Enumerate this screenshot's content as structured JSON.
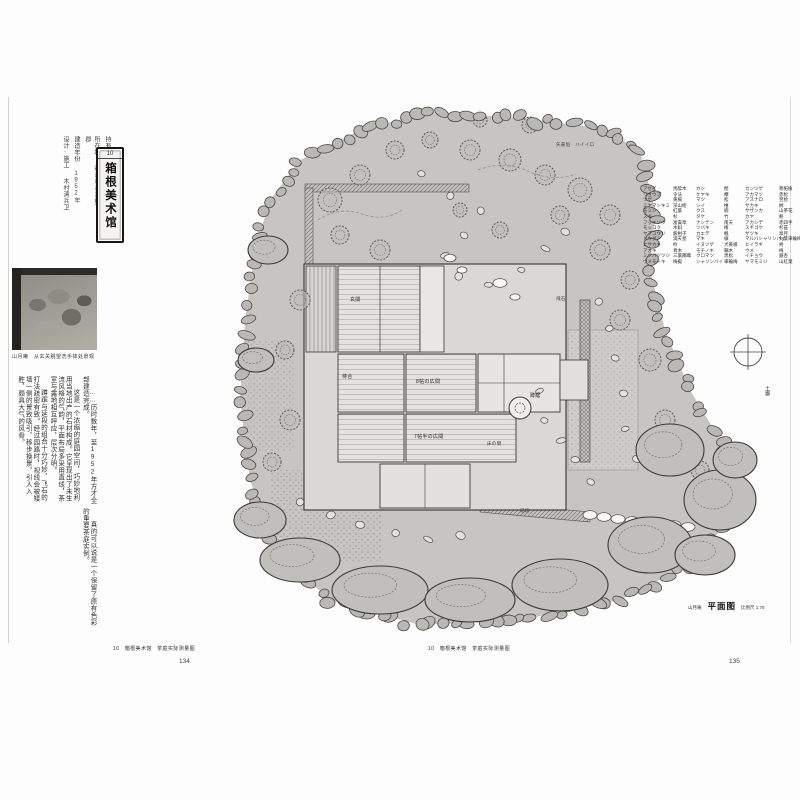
{
  "book": {
    "left_caption": "10　箱根美术馆　茶庭实际测量图",
    "right_caption": "10　箱根美术馆　茶庭实际测量图",
    "left_page_number": "134",
    "right_page_number": "135"
  },
  "left": {
    "chapter_no": "10",
    "title": "箱根美术馆",
    "meta": [
      {
        "label": "持有人",
        "value": "世界救世教"
      },
      {
        "label": "所在地",
        "value": "神奈川县足柄下郡"
      },
      {
        "label": "建造年份",
        "value": "1952年"
      },
      {
        "label": "设计·施工",
        "value": "木村清兵卫"
      }
    ],
    "photo_caption": "山月庵　从玄关眺望洗手钵处景观",
    "body": [
      "……历时数年，至1952年方才全部建造完成。",
      "这是一个浓缩的庭园空间，巧妙地利用当地出产的石材构成。它呈现出了未生流风格的气韵，平面布局多采用直线，茶室与露地相互呼应，层次分明。",
      "蹲踞与延段的组合十分巧妙，飞石的打法疏密有致。经过园路时，视线会被矮墙一侧的景致吸引，移步换景，引人入胜，颇具大气的风骨。",
      "真的可以说是一个保留了原有色彩的重要茶庭实例。"
    ]
  },
  "plan": {
    "title_block": {
      "name": "山月庵",
      "title": "平面图",
      "scale": "比例尺 1:75"
    },
    "labels": {
      "genkan": "玄関",
      "machiai": "待合",
      "hiroma8": "8帖の広間",
      "hiroma7": "7帖半の広間",
      "tokonoma": "床の間",
      "tsukubai": "蹲踞",
      "tobiishi": "飛石",
      "nobedan": "延段",
      "dobei": "土塀",
      "fence": "矢来垣　ハイイロ"
    },
    "legend_rows": [
      [
        "アセビ",
        "馬酔木",
        "カシ",
        "樫",
        "カンツゲ",
        "寒柘植"
      ],
      [
        "リョウブ",
        "令法",
        "ケヤキ",
        "欅",
        "アカマツ",
        "赤松"
      ],
      [
        "ツゲ",
        "黄楊",
        "マツ",
        "松",
        "アスナロ",
        "翌桧"
      ],
      [
        "ミヤマシキミ",
        "深山樒",
        "シイ",
        "椎",
        "サカキ",
        "榊"
      ],
      [
        "モミジ",
        "紅葉",
        "クス",
        "楠",
        "サザンカ",
        "山茶花"
      ],
      [
        "スギ",
        "杉",
        "タケ",
        "竹",
        "カヤ",
        "榧"
      ],
      [
        "フッキソウ",
        "富貴草",
        "ナンテン",
        "南天",
        "アカシデ",
        "赤四手"
      ],
      [
        "モッコク",
        "木斛",
        "ツバキ",
        "椿",
        "スギゴケ",
        "杉苔"
      ],
      [
        "ヤブコウジ",
        "薮柑子",
        "カエデ",
        "楓",
        "サツキ",
        "皐月"
      ],
      [
        "ドウダン",
        "満天星",
        "マキ",
        "槇",
        "マルバシャリンバイ",
        "丸葉車輪梅"
      ],
      [
        "ヒサカキ",
        "柃",
        "イヌツゲ",
        "犬黄楊",
        "ヒイラギ",
        "柊"
      ],
      [
        "アオキ",
        "青木",
        "モチノキ",
        "黐木",
        "ウメ",
        "梅"
      ],
      [
        "ミツバツツジ",
        "三葉躑躅",
        "クロマツ",
        "黒松",
        "イチョウ",
        "銀杏"
      ],
      [
        "ウメモドキ",
        "梅擬",
        "シャリンバイ",
        "車輪梅",
        "ヤマモミジ",
        "山紅葉"
      ]
    ],
    "colors": {
      "ground": "#c6c5c2",
      "line": "#3b3a37",
      "stone_white": "#f8f7f4"
    }
  }
}
